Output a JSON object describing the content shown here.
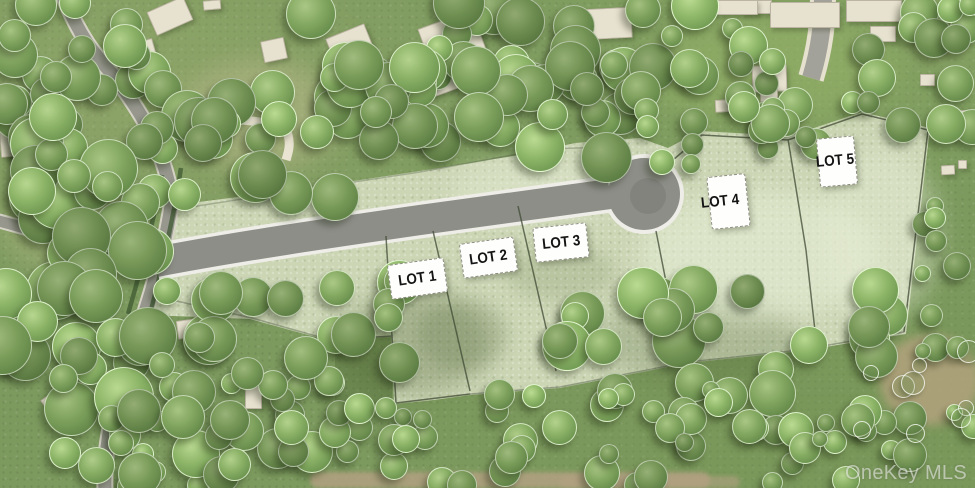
{
  "site_plan": {
    "lots": [
      {
        "label": "LOT 1"
      },
      {
        "label": "LOT 2"
      },
      {
        "label": "LOT 3"
      },
      {
        "label": "LOT 4"
      },
      {
        "label": "LOT 5"
      }
    ],
    "watermark": "OneKey MLS",
    "colors": {
      "parcel_grass": "#ccd6b5",
      "outer_grass": "#7c9a5e",
      "tree_green": "#6f9452",
      "road_asphalt": "#8d8e88",
      "road_edge": "#eeede7",
      "existing_road": "#97978e",
      "house_beige": "#e7e1cf",
      "dirt_tan": "#b3a182",
      "boundary_line": "#3f4a34",
      "label_background": "#fefefc",
      "label_text": "#141414"
    }
  }
}
